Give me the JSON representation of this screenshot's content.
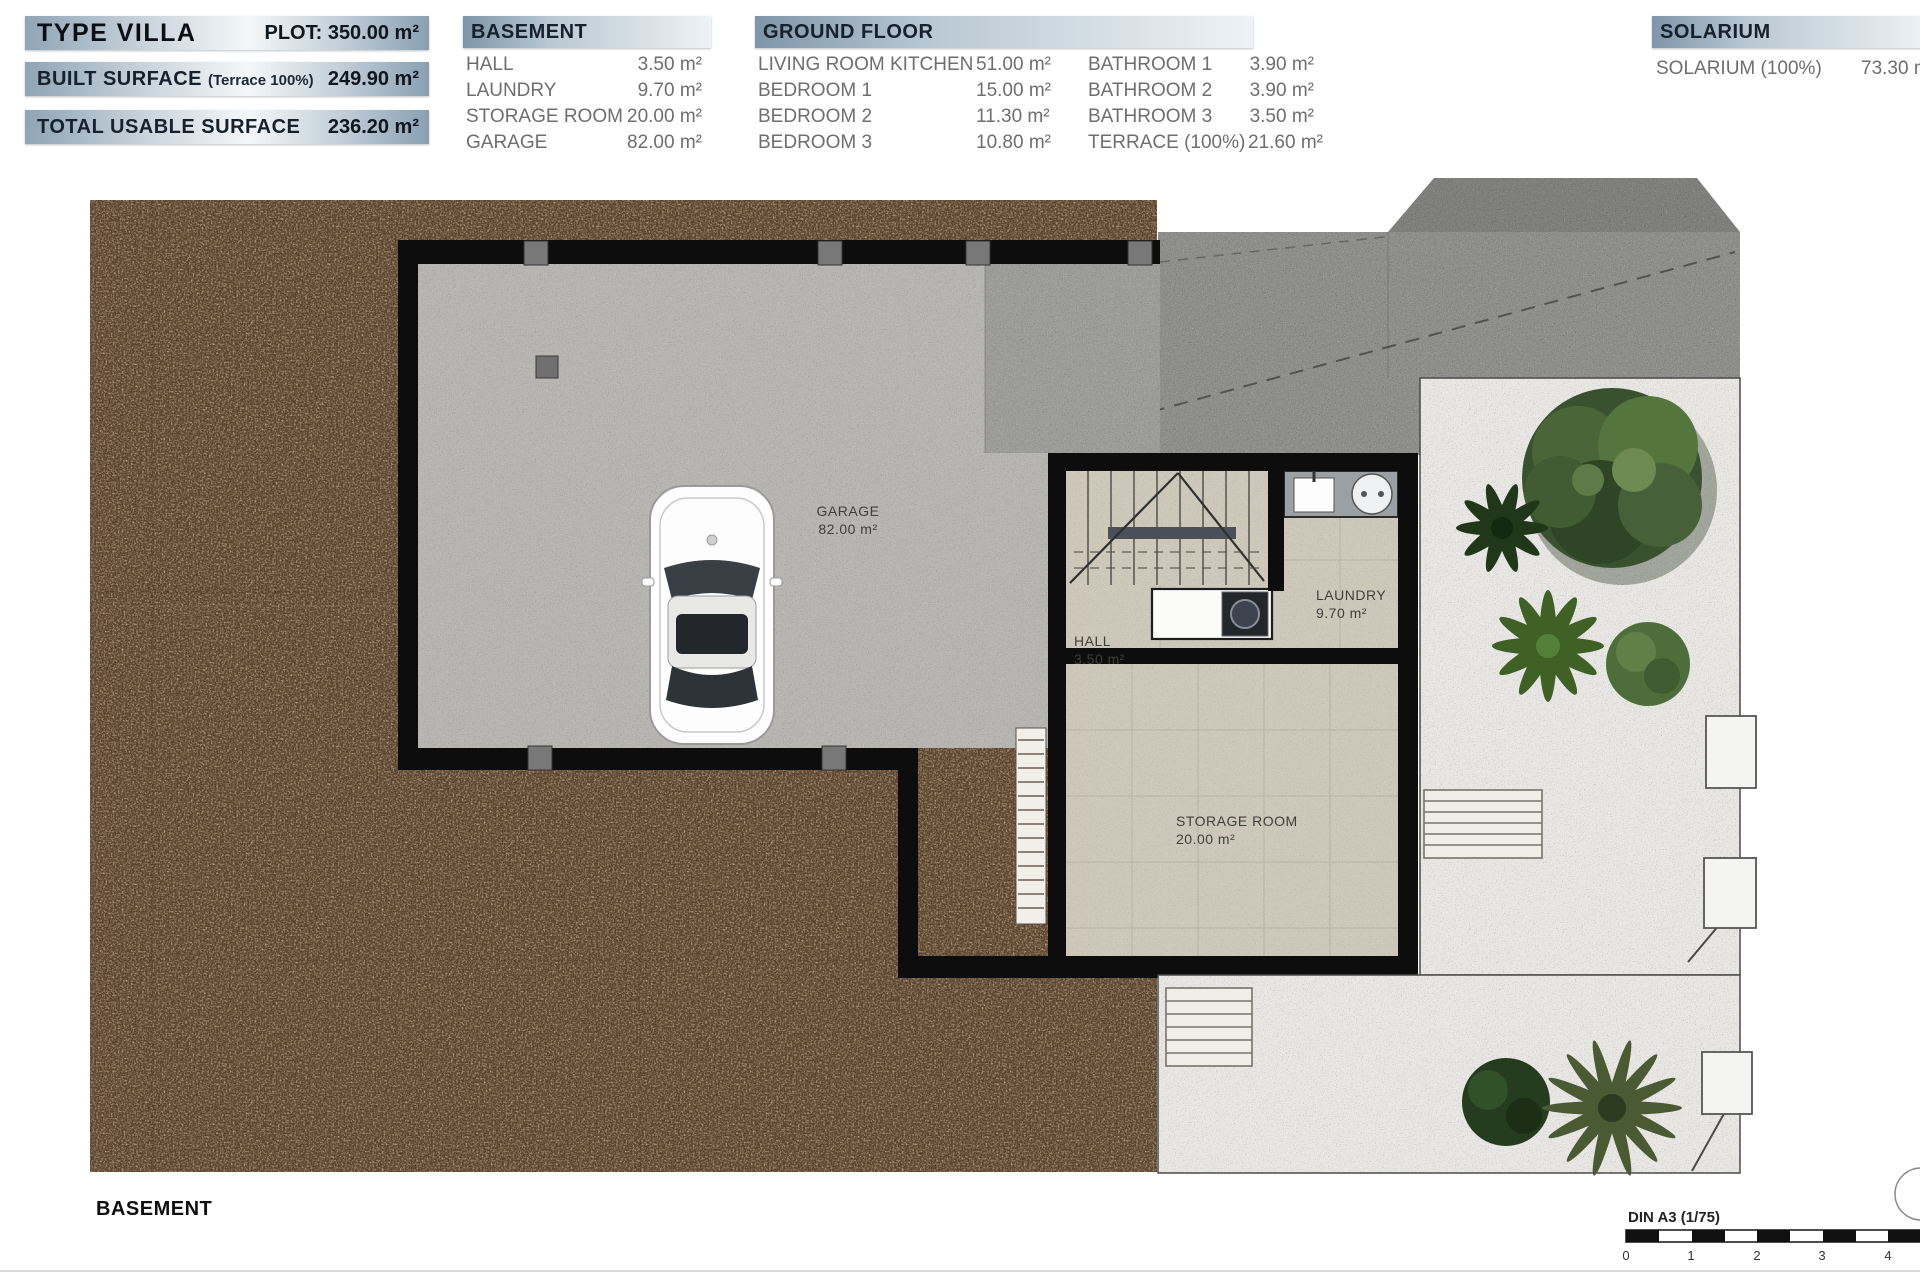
{
  "header": {
    "summary": [
      {
        "label": "TYPE VILLA",
        "value": "PLOT: 350.00 m²"
      },
      {
        "label": "BUILT SURFACE",
        "sublabel": "(Terrace 100%)",
        "value": "249.90 m²"
      },
      {
        "label": "TOTAL USABLE SURFACE",
        "value": "236.20 m²"
      }
    ],
    "tables": [
      {
        "title": "BASEMENT",
        "rows": [
          [
            "HALL",
            "3.50 m²"
          ],
          [
            "LAUNDRY",
            "9.70 m²"
          ],
          [
            "STORAGE ROOM",
            "20.00 m²"
          ],
          [
            "GARAGE",
            "82.00 m²"
          ]
        ]
      },
      {
        "title": "GROUND FLOOR",
        "rows": [
          [
            "LIVING ROOM KITCHEN",
            "51.00 m²",
            "BATHROOM 1",
            "3.90 m²"
          ],
          [
            "BEDROOM 1",
            "15.00 m²",
            "BATHROOM 2",
            "3.90 m²"
          ],
          [
            "BEDROOM 2",
            "11.30 m²",
            "BATHROOM 3",
            "3.50 m²"
          ],
          [
            "BEDROOM 3",
            "10.80 m²",
            "TERRACE (100%)",
            "21.60 m²"
          ]
        ]
      },
      {
        "title": "SOLARIUM",
        "rows": [
          [
            "SOLARIUM (100%)",
            "73.30 m²"
          ]
        ]
      }
    ]
  },
  "plan": {
    "floor_label": "BASEMENT",
    "rooms": {
      "garage": {
        "name": "GARAGE",
        "area": "82.00 m²"
      },
      "hall": {
        "name": "HALL",
        "area": "3.50 m²"
      },
      "laundry": {
        "name": "LAUNDRY",
        "area": "9.70 m²"
      },
      "storage": {
        "name": "STORAGE ROOM",
        "area": "20.00 m²"
      }
    },
    "scale": {
      "label": "DIN A3 (1/75)",
      "ticks": [
        "0",
        "1",
        "2",
        "3",
        "4"
      ]
    }
  },
  "colors": {
    "bar_gradient_dark": "#7e95a9",
    "bar_gradient_light": "#f2f6f8",
    "text_dark": "#16212d",
    "text_gray": "#6e6e6e",
    "dirt_brown": "#5c442d",
    "concrete_gray": "#b6b5b2",
    "driveway_gray": "#8e8e8c",
    "tile_beige": "#cec8ba",
    "gravel_white": "#e8e7e4",
    "wall_black": "#0d0d0d",
    "tree_green": "#45633a"
  }
}
